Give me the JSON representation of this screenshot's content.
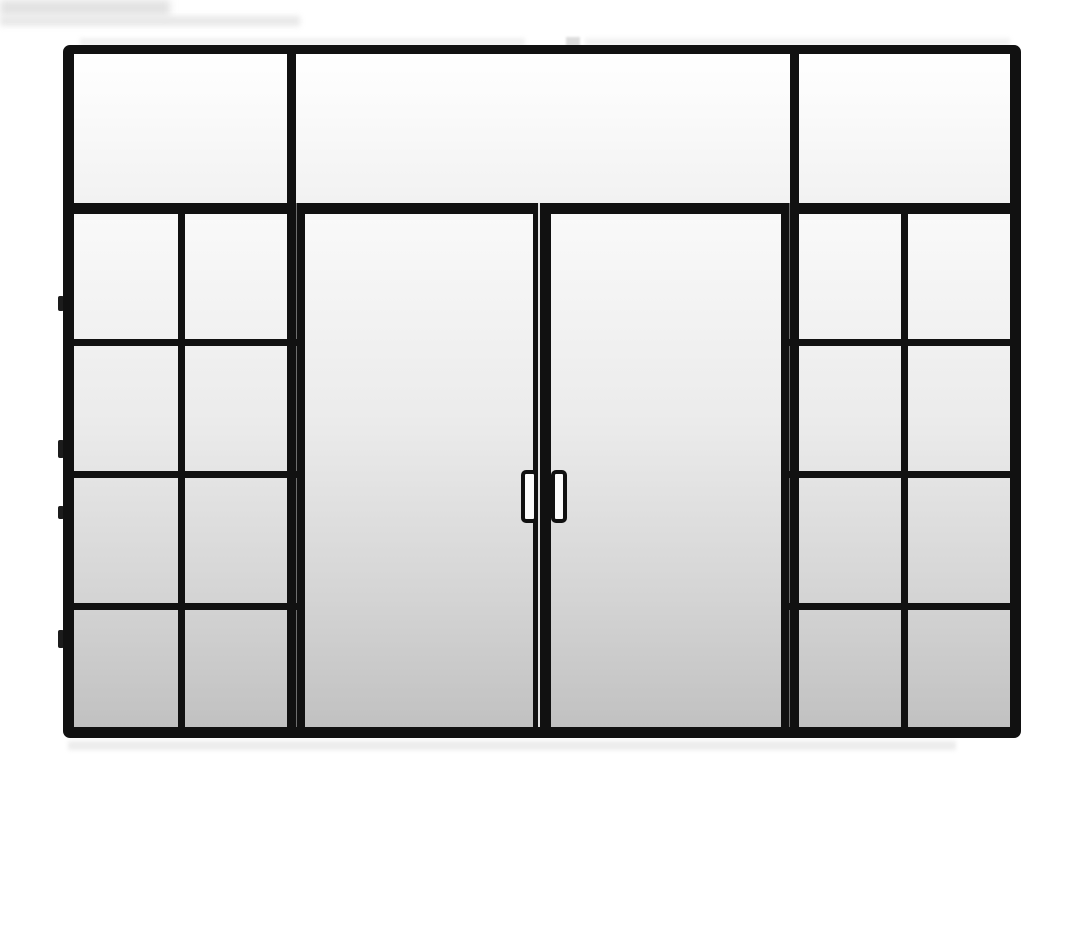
{
  "scene": {
    "subject": "black steel-framed glass door system with double doors, gridded sidelites and transom panels, product photo on white background"
  },
  "structure": {
    "transom_panes": 3,
    "doors": 2,
    "door_handles": 2,
    "left_sidelite_grid": {
      "columns": 2,
      "rows": 4,
      "panes": 8
    },
    "right_sidelite_grid": {
      "columns": 2,
      "rows": 4,
      "panes": 8
    }
  },
  "colors": {
    "background-color": "#ffffff",
    "frame-color": "#111111",
    "seam-color": "#6e6e6e",
    "meeting-gap-color": "#e3e3e3",
    "transom-glass-top": "#ffffff",
    "transom-glass-bottom": "#f2f2f2",
    "glass-top": "#fafafa",
    "glass-bottom": "#c1c1c1",
    "handle-fill": "#fcfcfc",
    "halo-color": "#e9e9e9"
  }
}
